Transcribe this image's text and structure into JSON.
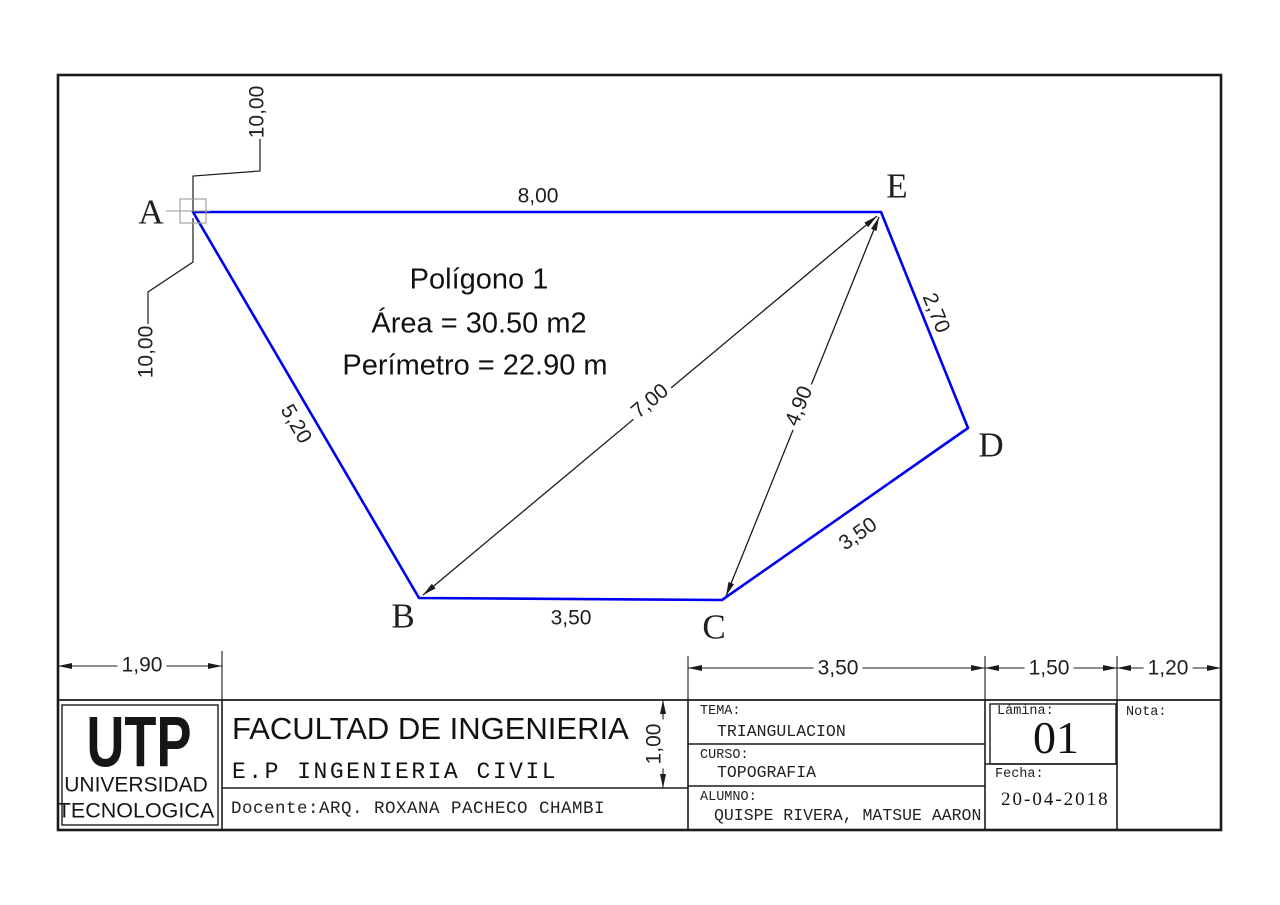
{
  "polygon": {
    "title": "Polígono 1",
    "area": "Área = 30.50 m2",
    "perimeter": "Perímetro = 22.90 m",
    "vertex_a": "A",
    "vertex_b": "B",
    "vertex_c": "C",
    "vertex_d": "D",
    "vertex_e": "E",
    "dim_ae": "8,00",
    "dim_ab": "5,20",
    "dim_bc": "3,50",
    "dim_cd": "3,50",
    "dim_de": "2,70",
    "dim_be": "7,00",
    "dim_ce": "4,90",
    "offset_top": "10,00",
    "offset_left": "10,00",
    "outline_color": "#0000f2",
    "line_color": "#1b1b1b"
  },
  "sheet_dims": {
    "utp_cell_width": "1,90",
    "tema_cell_width": "3,50",
    "lamina_cell_width": "1,50",
    "nota_cell_width": "1,20",
    "header_row_height": "1,00"
  },
  "title_block": {
    "logo_abbr": "UTP",
    "logo_line1": "UNIVERSIDAD",
    "logo_line2": "TECNOLOGICA",
    "faculty": "FACULTAD DE INGENIERIA",
    "school": "E.P INGENIERIA CIVIL",
    "docente": "Docente:ARQ. ROXANA PACHECO CHAMBI",
    "tema_label": "TEMA:",
    "tema_value": "TRIANGULACION",
    "curso_label": "CURSO:",
    "curso_value": "TOPOGRAFIA",
    "alumno_label": "ALUMNO:",
    "alumno_value": "QUISPE RIVERA, MATSUE AARON",
    "lamina_label": "Lámina:",
    "lamina_value": "01",
    "fecha_label": "Fecha:",
    "fecha_value": "20-04-2018",
    "nota_label": "Nota:"
  }
}
